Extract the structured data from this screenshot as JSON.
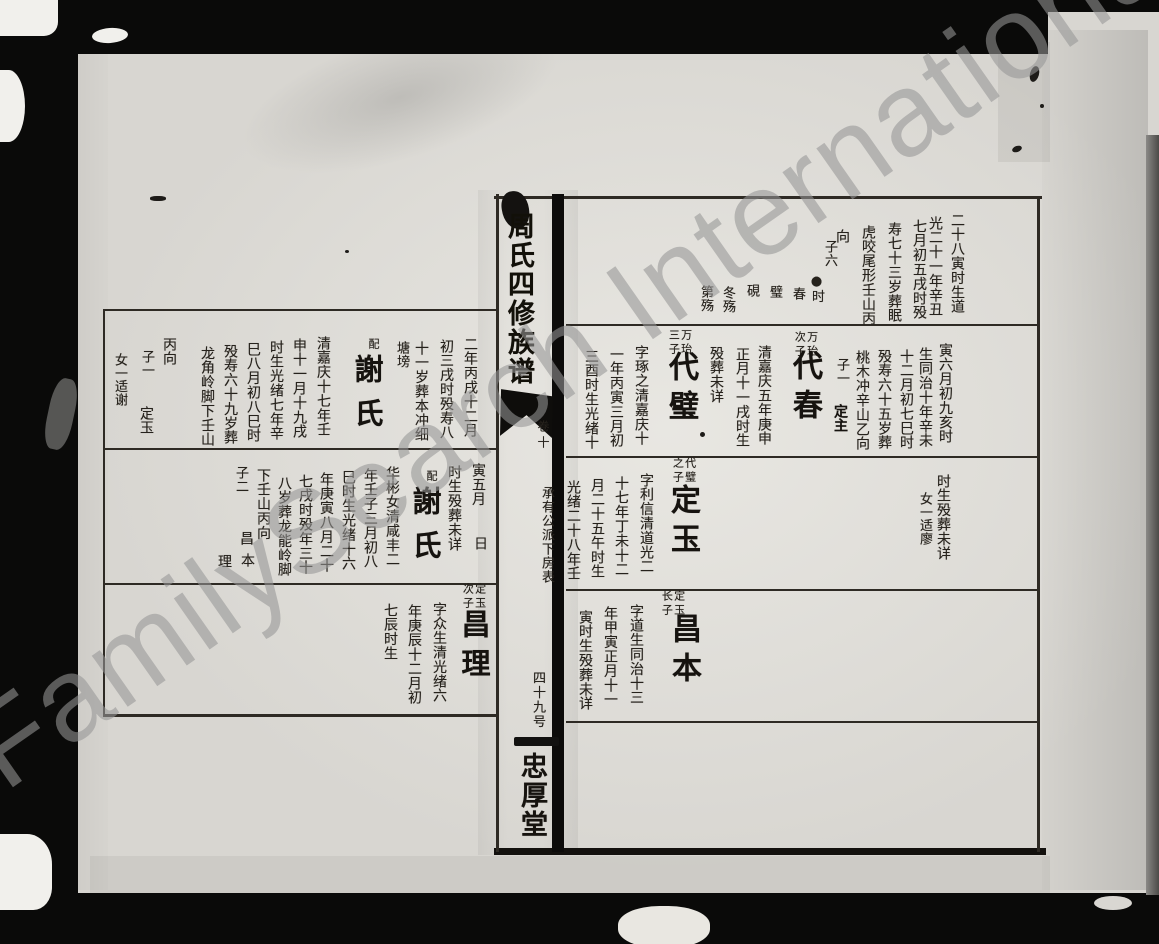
{
  "watermark": {
    "text": "FamilySearch International"
  },
  "spine": {
    "title": "周氏四修族谱",
    "volume": "卷十",
    "chart_title": "承有公派下房表",
    "sheet_number": "四十九号",
    "hall_name": "忠厚堂"
  },
  "right_page": {
    "columns": [
      {
        "n": "bio-column",
        "t": "二十八寅时生道",
        "x": 950,
        "y": 213
      },
      {
        "n": "bio-column",
        "t": "光二十一年辛丑",
        "x": 928,
        "y": 216
      },
      {
        "n": "bio-column",
        "t": "七月初五戌时殁",
        "x": 912,
        "y": 219
      },
      {
        "n": "bio-column",
        "t": "寿七十三岁葬眠",
        "x": 887,
        "y": 222
      },
      {
        "n": "bio-column",
        "t": "虎咬尾形壬山丙",
        "x": 861,
        "y": 225
      },
      {
        "n": "bio-column",
        "t": "向",
        "x": 835,
        "y": 229
      },
      {
        "n": "sons-count",
        "t": "子六",
        "x": 823,
        "y": 240,
        "fs": 13
      },
      {
        "n": "son-name",
        "t": "●时",
        "x": 810,
        "y": 274,
        "fs": 13
      },
      {
        "n": "son-name",
        "t": "春",
        "x": 791,
        "y": 287,
        "fs": 13
      },
      {
        "n": "son-name",
        "t": "璧",
        "x": 768,
        "y": 285,
        "fs": 13
      },
      {
        "n": "son-name",
        "t": "硯",
        "x": 745,
        "y": 284,
        "fs": 13
      },
      {
        "n": "son-name",
        "t": "冬殇",
        "x": 721,
        "y": 286,
        "fs": 13
      },
      {
        "n": "son-name",
        "t": "第殇",
        "x": 699,
        "y": 285,
        "fs": 13
      },
      {
        "n": "bio-column",
        "t": "寅六月初九亥时",
        "x": 938,
        "y": 343
      },
      {
        "n": "bio-column",
        "t": "生同治十年辛未",
        "x": 918,
        "y": 347
      },
      {
        "n": "bio-column",
        "t": "十二月初七巳时",
        "x": 899,
        "y": 349
      },
      {
        "n": "bio-column",
        "t": "殁寿六十五岁葬",
        "x": 877,
        "y": 349
      },
      {
        "n": "bio-column",
        "t": "桃木冲辛山乙向",
        "x": 855,
        "y": 350
      },
      {
        "n": "sons-count",
        "t": "子一",
        "x": 835,
        "y": 358,
        "fs": 13
      },
      {
        "n": "son-name",
        "t": "定主",
        "x": 833,
        "y": 404,
        "fs": 14,
        "b": true
      },
      {
        "n": "relation-label",
        "t": "万珆次子",
        "x": 793,
        "y": 331,
        "fs": 11,
        "h": 30,
        "ls": 3
      },
      {
        "n": "person-name",
        "t": "代春",
        "x": 789,
        "y": 350,
        "fs": 30,
        "b": true,
        "ls": 9
      },
      {
        "n": "bio-column",
        "t": "清嘉庆五年庚申",
        "x": 757,
        "y": 345
      },
      {
        "n": "bio-column",
        "t": "正月十一戌时生",
        "x": 735,
        "y": 347
      },
      {
        "n": "bio-column",
        "t": "殁葬未详",
        "x": 709,
        "y": 346
      },
      {
        "n": "relation-label",
        "t": "万珆三子",
        "x": 667,
        "y": 329,
        "fs": 11,
        "h": 30,
        "ls": 3
      },
      {
        "n": "person-name",
        "t": "代璧",
        "x": 665,
        "y": 351,
        "fs": 30,
        "b": true,
        "ls": 9
      },
      {
        "n": "bio-column",
        "t": "字琢之清嘉庆十",
        "x": 634,
        "y": 345
      },
      {
        "n": "bio-column",
        "t": "一年丙寅三月初",
        "x": 609,
        "y": 347
      },
      {
        "n": "bio-column",
        "t": "三酉时生光绪十",
        "x": 584,
        "y": 349
      },
      {
        "n": "bio-column",
        "t": "时生殁葬未详",
        "x": 936,
        "y": 474
      },
      {
        "n": "daughter-note",
        "t": "女一适廖",
        "x": 918,
        "y": 492,
        "fs": 13
      },
      {
        "n": "relation-label",
        "t": "代璧之子",
        "x": 671,
        "y": 457,
        "fs": 11,
        "h": 30,
        "ls": 3
      },
      {
        "n": "person-name",
        "t": "定玉",
        "x": 667,
        "y": 484,
        "fs": 30,
        "b": true,
        "ls": 9
      },
      {
        "n": "bio-column",
        "t": "字利信清道光二",
        "x": 639,
        "y": 473
      },
      {
        "n": "bio-column",
        "t": "十七年丁未十二",
        "x": 614,
        "y": 476
      },
      {
        "n": "bio-column",
        "t": "月二十五午时生",
        "x": 590,
        "y": 478
      },
      {
        "n": "bio-column",
        "t": "光绪二十八年壬",
        "x": 566,
        "y": 480
      },
      {
        "n": "relation-label",
        "t": "定玉长子",
        "x": 660,
        "y": 590,
        "fs": 11,
        "h": 30,
        "ls": 3
      },
      {
        "n": "person-name",
        "t": "昌本",
        "x": 668,
        "y": 613,
        "fs": 30,
        "b": true,
        "ls": 9
      },
      {
        "n": "bio-column",
        "t": "字道生同治十三",
        "x": 629,
        "y": 604
      },
      {
        "n": "bio-column",
        "t": "年甲寅正月十一",
        "x": 603,
        "y": 606
      },
      {
        "n": "bio-column",
        "t": "寅时生殁葬未详",
        "x": 578,
        "y": 610
      }
    ]
  },
  "left_page": {
    "columns": [
      {
        "n": "bio-column",
        "t": "二年丙戌十二月",
        "x": 463,
        "y": 337
      },
      {
        "n": "bio-column",
        "t": "初三戌时殁寿八",
        "x": 439,
        "y": 339
      },
      {
        "n": "bio-column",
        "t": "十一岁葬本冲细",
        "x": 414,
        "y": 341
      },
      {
        "n": "bio-column",
        "t": "塘塝",
        "x": 395,
        "y": 341,
        "fs": 13
      },
      {
        "n": "relation-label",
        "t": "配",
        "x": 368,
        "y": 338,
        "fs": 11
      },
      {
        "n": "person-name",
        "t": "謝氏",
        "x": 352,
        "y": 354,
        "fs": 29,
        "b": true,
        "ls": 15
      },
      {
        "n": "bio-column",
        "t": "清嘉庆十七年壬",
        "x": 316,
        "y": 336
      },
      {
        "n": "bio-column",
        "t": "申十一月十九戌",
        "x": 292,
        "y": 338
      },
      {
        "n": "bio-column",
        "t": "时生光绪七年辛",
        "x": 269,
        "y": 340
      },
      {
        "n": "bio-column",
        "t": "巳八月初八巳时",
        "x": 246,
        "y": 342
      },
      {
        "n": "bio-column",
        "t": "殁寿六十九岁葬",
        "x": 223,
        "y": 344
      },
      {
        "n": "bio-column",
        "t": "龙角岭脚下壬山",
        "x": 200,
        "y": 346
      },
      {
        "n": "bio-column",
        "t": "丙向",
        "x": 162,
        "y": 337
      },
      {
        "n": "sons-count",
        "t": "子一",
        "x": 140,
        "y": 350,
        "fs": 13
      },
      {
        "n": "son-name",
        "t": "定玉",
        "x": 139,
        "y": 406,
        "fs": 14
      },
      {
        "n": "daughter-note",
        "t": "女一适谢",
        "x": 113,
        "y": 353,
        "fs": 13
      },
      {
        "n": "bio-column",
        "t": "寅五月",
        "x": 471,
        "y": 463
      },
      {
        "n": "bio-column",
        "t": "日",
        "x": 473,
        "y": 536
      },
      {
        "n": "bio-column",
        "t": "时生殁葬未详",
        "x": 447,
        "y": 465
      },
      {
        "n": "relation-label",
        "t": "配",
        "x": 426,
        "y": 470,
        "fs": 11
      },
      {
        "n": "person-name",
        "t": "謝氏",
        "x": 410,
        "y": 486,
        "fs": 29,
        "b": true,
        "ls": 15
      },
      {
        "n": "bio-column",
        "t": "华彬女清咸丰二",
        "x": 385,
        "y": 466
      },
      {
        "n": "bio-column",
        "t": "年壬子三月初八",
        "x": 363,
        "y": 468
      },
      {
        "n": "bio-column",
        "t": "巳时生光绪十六",
        "x": 341,
        "y": 470
      },
      {
        "n": "bio-column",
        "t": "年庚寅八月二十",
        "x": 319,
        "y": 472
      },
      {
        "n": "bio-column",
        "t": "七戌时殁年三十",
        "x": 298,
        "y": 474
      },
      {
        "n": "bio-column",
        "t": "八岁葬龙能岭脚",
        "x": 277,
        "y": 476
      },
      {
        "n": "bio-column",
        "t": "下壬山丙向",
        "x": 256,
        "y": 468
      },
      {
        "n": "sons-count",
        "t": "子二",
        "x": 234,
        "y": 466,
        "fs": 13
      },
      {
        "n": "son-name",
        "t": "昌",
        "x": 239,
        "y": 531,
        "fs": 14
      },
      {
        "n": "son-name",
        "t": "本",
        "x": 240,
        "y": 553,
        "fs": 14
      },
      {
        "n": "son-name",
        "t": "理",
        "x": 217,
        "y": 554,
        "fs": 14
      },
      {
        "n": "relation-label",
        "t": "定玉次子",
        "x": 461,
        "y": 583,
        "fs": 11,
        "h": 30,
        "ls": 3
      },
      {
        "n": "person-name",
        "t": "昌理",
        "x": 459,
        "y": 609,
        "fs": 29,
        "b": true,
        "ls": 10
      },
      {
        "n": "bio-column",
        "t": "字众生清光绪六",
        "x": 432,
        "y": 602
      },
      {
        "n": "bio-column",
        "t": "年庚辰十二月初",
        "x": 407,
        "y": 604
      },
      {
        "n": "bio-column",
        "t": "七辰时生",
        "x": 383,
        "y": 603
      }
    ]
  }
}
